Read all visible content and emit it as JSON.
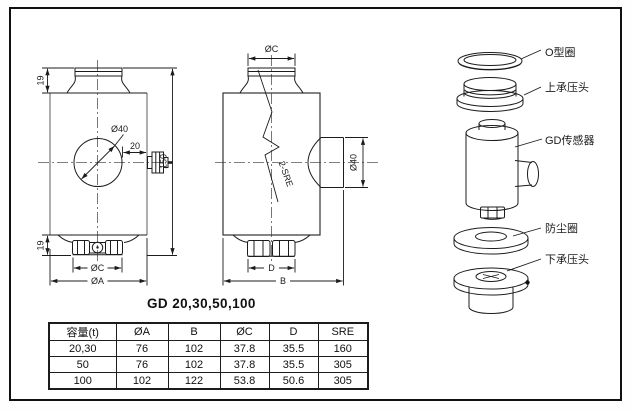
{
  "title": "GD 20,30,50,100",
  "front_view": {
    "dim_cap_height": "19",
    "dim_total_height": "150",
    "dim_hole_dia": "Ø40",
    "dim_connector_len": "20",
    "dim_base_height": "19",
    "dim_oc": "ØC",
    "dim_oa": "ØA"
  },
  "side_view": {
    "dim_oc": "ØC",
    "cable_label": "2-SRE",
    "dim_boss_dia": "Ø40",
    "dim_d": "D",
    "dim_b": "B"
  },
  "exploded": {
    "labels": [
      "O型圈",
      "上承压头",
      "GD传感器",
      "防尘圈",
      "下承压头"
    ]
  },
  "table": {
    "headers": [
      "容量(t)",
      "ØA",
      "B",
      "ØC",
      "D",
      "SRE"
    ],
    "rows": [
      [
        "20,30",
        "76",
        "102",
        "37.8",
        "35.5",
        "160"
      ],
      [
        "50",
        "76",
        "102",
        "37.8",
        "35.5",
        "305"
      ],
      [
        "100",
        "102",
        "122",
        "53.8",
        "50.6",
        "305"
      ]
    ]
  },
  "colors": {
    "line": "#1c1c1c",
    "light_line": "#9a9a9a",
    "background": "#ffffff"
  }
}
